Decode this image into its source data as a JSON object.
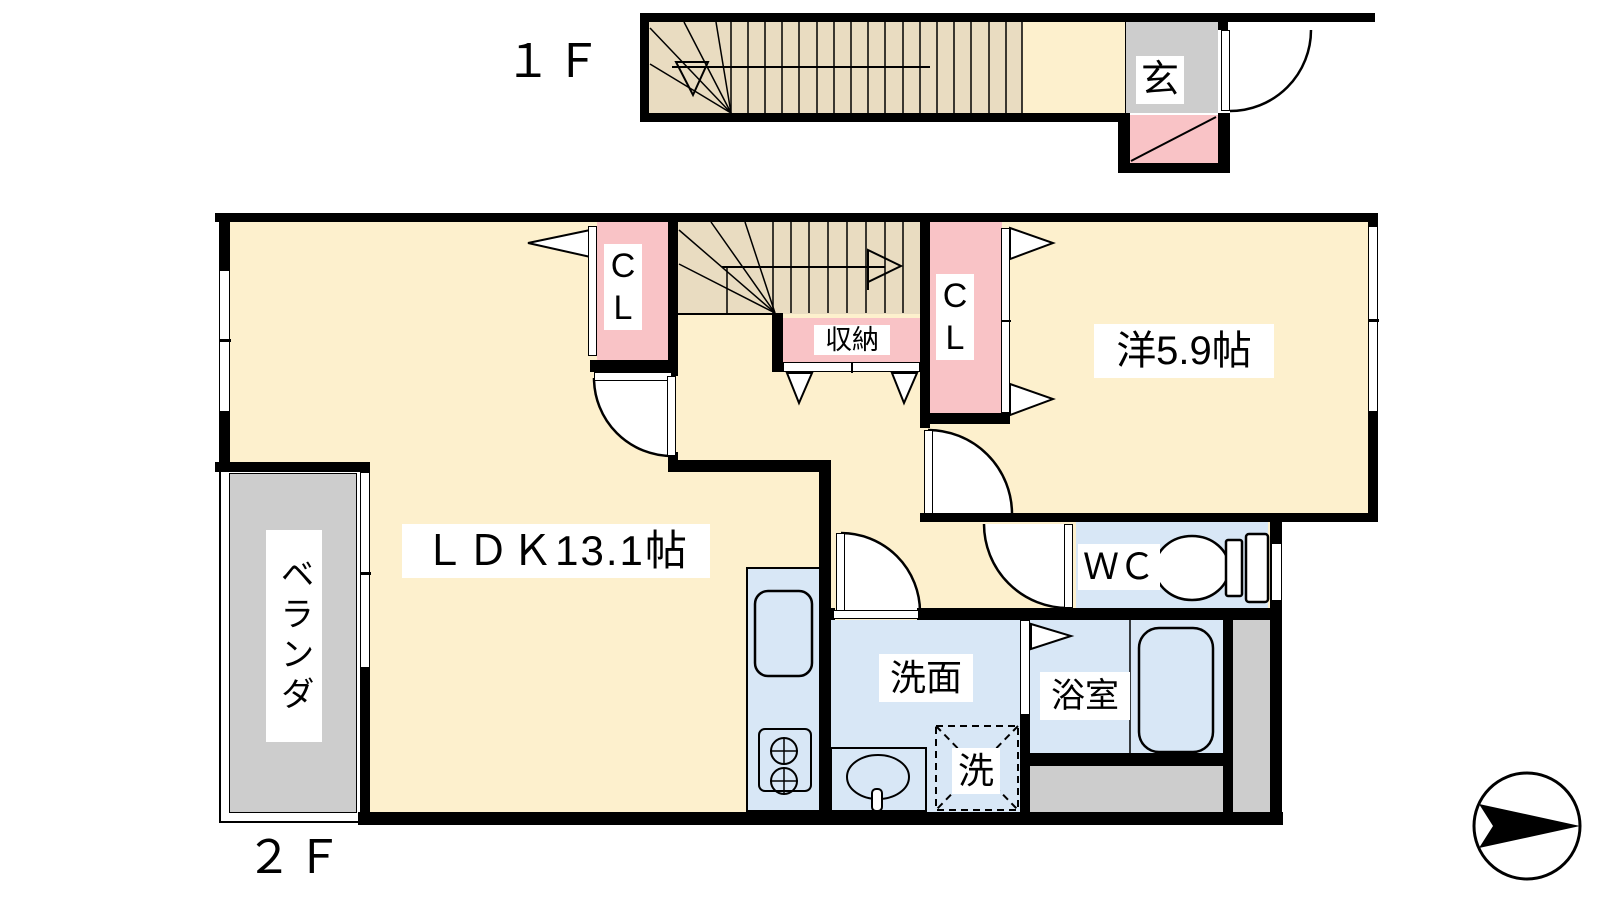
{
  "colors": {
    "wall": "#000000",
    "room_cream": "#fdf0cd",
    "stairs_tan": "#e9dcc1",
    "closet_pink": "#f9c3c6",
    "wet_area_blue": "#d8e7f6",
    "outdoor_gray": "#cdcdcd"
  },
  "floor1": {
    "title": "１Ｆ",
    "rooms": {
      "entrance": "玄"
    }
  },
  "floor2": {
    "title": "２Ｆ",
    "rooms": {
      "ldk": "ＬＤＫ13.1帖",
      "bedroom": "洋5.9帖",
      "closet_c": "C",
      "closet_l": "L",
      "storage": "収納",
      "wc": "ＷＣ",
      "washroom": "洗面",
      "bathroom": "浴室",
      "laundry": "洗",
      "veranda": "ベランダ"
    }
  },
  "icons": {
    "compass": "direction-arrow"
  }
}
